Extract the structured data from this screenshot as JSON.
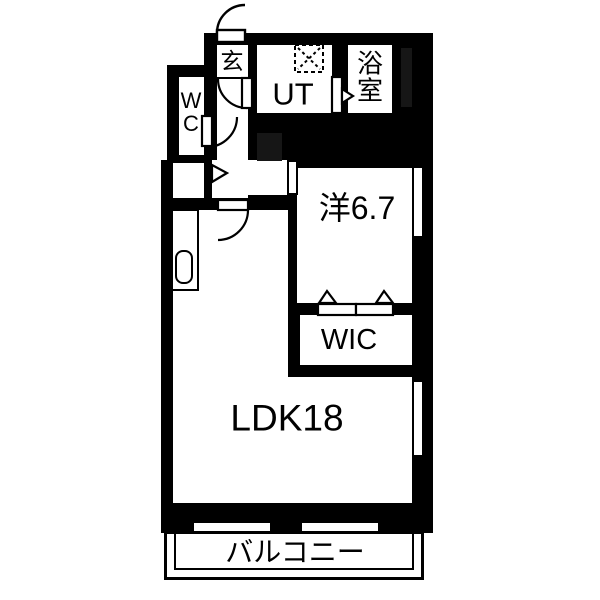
{
  "floorplan": {
    "type": "japanese-apartment-floorplan",
    "rooms": {
      "genkan": {
        "label": "玄"
      },
      "ut": {
        "label": "UT"
      },
      "bathroom": {
        "label": "浴室",
        "line1": "浴",
        "line2": "室"
      },
      "wc": {
        "label": "WC",
        "line1": "W",
        "line2": "C"
      },
      "western": {
        "label": "洋6.7"
      },
      "wic": {
        "label": "WIC"
      },
      "ldk": {
        "label": "LDK18"
      },
      "balcony": {
        "label": "バルコニー"
      }
    },
    "colors": {
      "wall": "#000000",
      "floor": "#ffffff",
      "shaft": "#161616"
    }
  }
}
